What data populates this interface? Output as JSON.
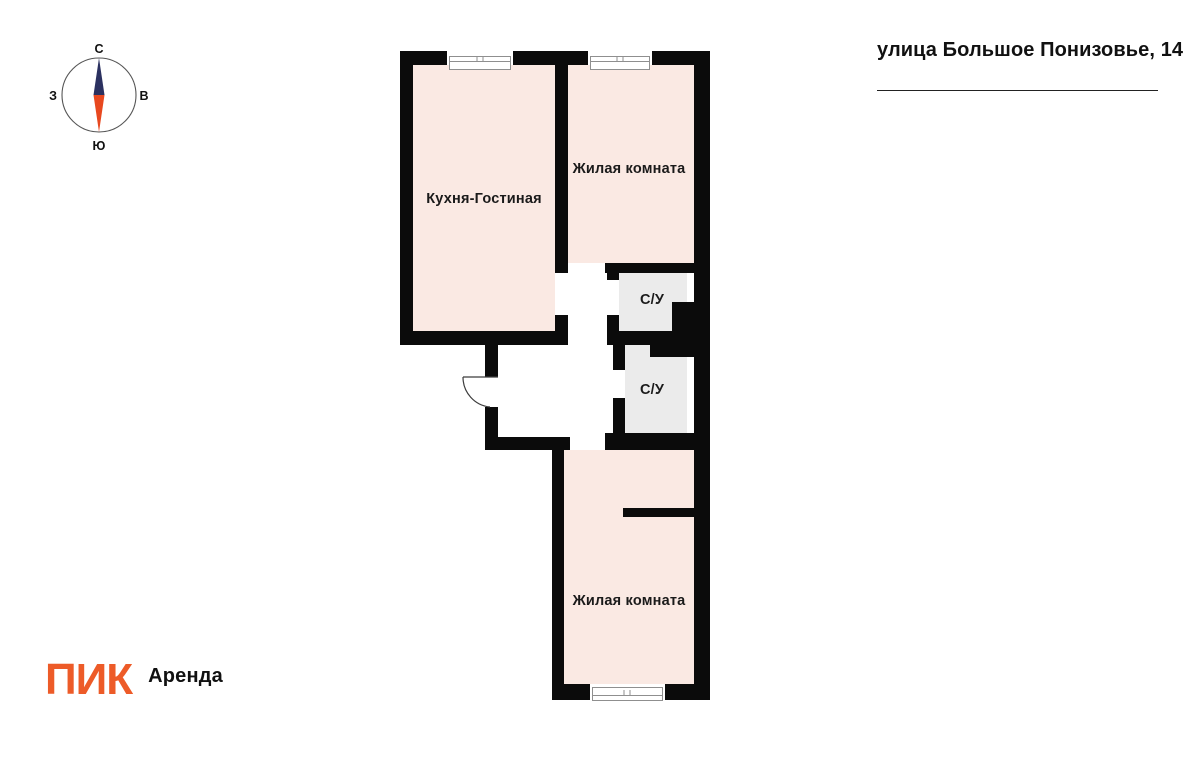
{
  "header": {
    "address": "улица Большое Понизовье, 14"
  },
  "compass": {
    "north": "С",
    "south": "Ю",
    "west": "З",
    "east": "В",
    "needle_north_color": "#2b3160",
    "needle_south_color": "#e8481f"
  },
  "plan": {
    "rooms": {
      "kitchen_living": "Кухня-Гостиная",
      "bedroom_top": "Жилая комната",
      "bathroom_top": "С/У",
      "bathroom_bottom": "С/У",
      "bedroom_bottom": "Жилая комната"
    },
    "colors": {
      "room_fill": "#FAE9E3",
      "bathroom_fill": "#EBEBEB",
      "wall": "#0B0B0B"
    }
  },
  "branding": {
    "logo_text": "ПИК",
    "product_text": "Аренда",
    "logo_color": "#ED5B28"
  }
}
